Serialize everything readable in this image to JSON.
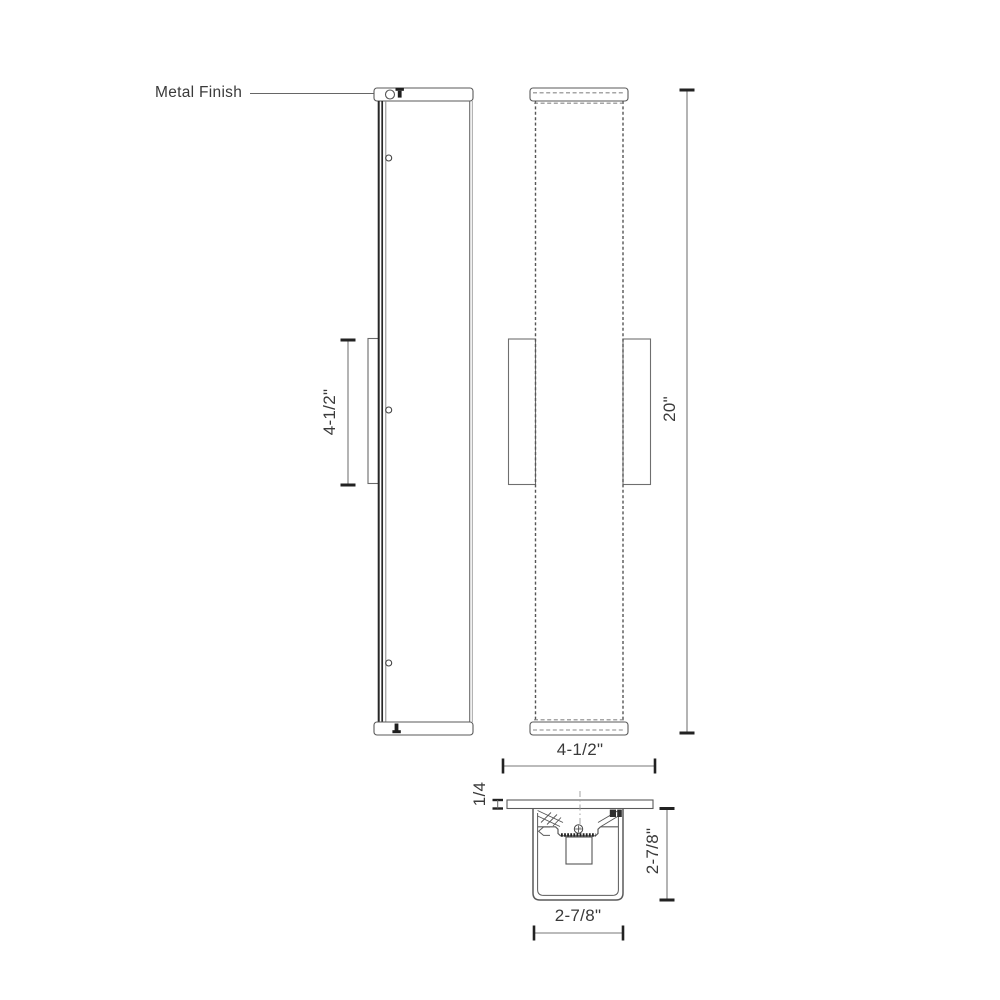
{
  "annotation": {
    "metal_finish": "Metal Finish"
  },
  "dimensions": {
    "backplate_height": "4-1/2\"",
    "fixture_height": "20\"",
    "fixture_width": "4-1/2\"",
    "faceplate_thickness": "1/4",
    "section_depth": "2-7/8\"",
    "section_width": "2-7/8\""
  },
  "colors": {
    "background": "#ffffff",
    "line": "#5a5a5a",
    "dark": "#222222",
    "dashed": "#777777",
    "text": "#3a3a3a"
  }
}
